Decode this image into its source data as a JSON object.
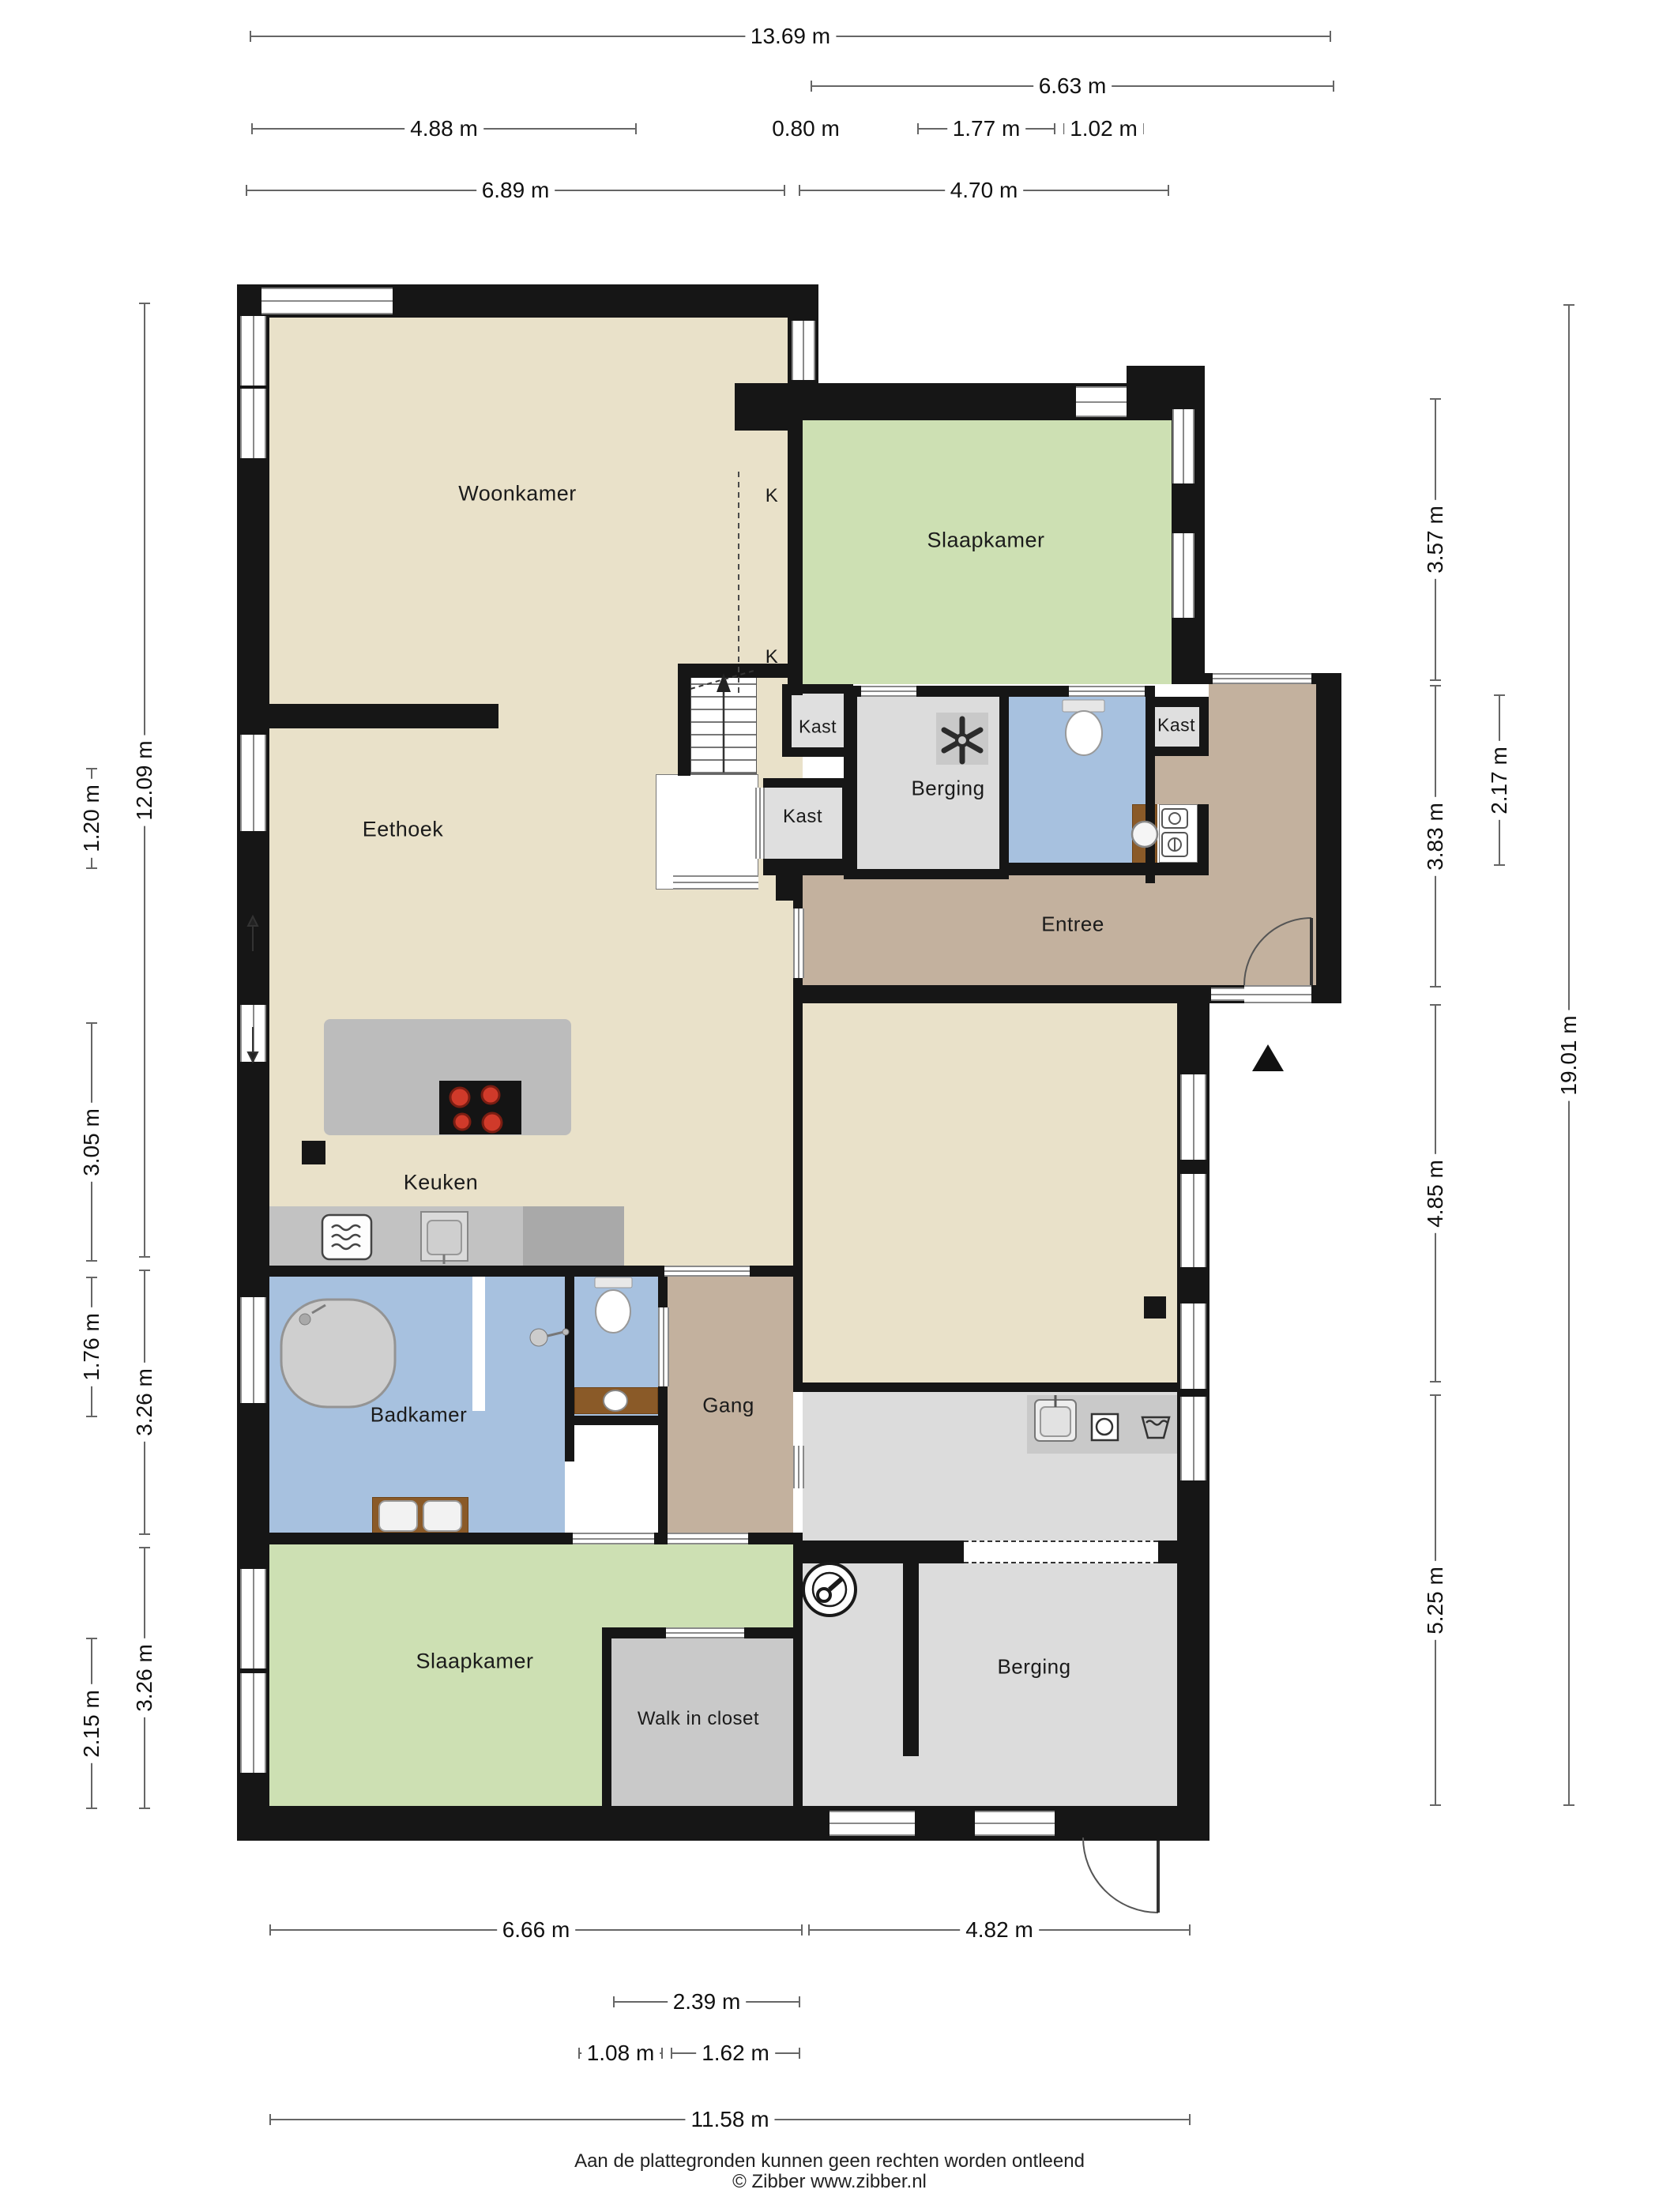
{
  "labels": [
    {
      "text": "Woonkamer"
    },
    {
      "text": "Slaapkamer"
    },
    {
      "text": "K"
    },
    {
      "text": "K"
    },
    {
      "text": "Kast"
    },
    {
      "text": "Kast"
    },
    {
      "text": "Kast"
    },
    {
      "text": "Berging"
    },
    {
      "text": "Entree"
    },
    {
      "text": "Eethoek"
    },
    {
      "text": "Keuken"
    },
    {
      "text": "Badkamer"
    },
    {
      "text": "Gang"
    },
    {
      "text": "Slaapkamer"
    },
    {
      "text": "Walk in closet"
    },
    {
      "text": "Berging"
    }
  ],
  "dims": [
    {
      "text": "13.69 m"
    },
    {
      "text": "6.63 m"
    },
    {
      "text": "4.88 m"
    },
    {
      "text": "0.80 m"
    },
    {
      "text": "1.77 m"
    },
    {
      "text": "1.02 m"
    },
    {
      "text": "6.89 m"
    },
    {
      "text": "4.70 m"
    },
    {
      "text": "12.09 m"
    },
    {
      "text": "3.26 m"
    },
    {
      "text": "3.26 m"
    },
    {
      "text": "1.20 m"
    },
    {
      "text": "3.05 m"
    },
    {
      "text": "1.76 m"
    },
    {
      "text": "2.15 m"
    },
    {
      "text": "3.57 m"
    },
    {
      "text": "3.83 m"
    },
    {
      "text": "4.85 m"
    },
    {
      "text": "5.25 m"
    },
    {
      "text": "2.17 m"
    },
    {
      "text": "19.01 m"
    },
    {
      "text": "6.66 m"
    },
    {
      "text": "4.82 m"
    },
    {
      "text": "2.39 m"
    },
    {
      "text": "1.08 m"
    },
    {
      "text": "1.62 m"
    },
    {
      "text": "11.58 m"
    }
  ],
  "footer": {
    "line1": "Aan de plattegronden kunnen geen rechten worden ontleend",
    "line2": "© Zibber www.zibber.nl"
  },
  "colors": {
    "floor": "#e9e1c9",
    "bedroom": "#cde0b3",
    "bath": "#a7c1df",
    "hall": "#c3b19e",
    "storage": "#dcdcdc",
    "wall": "#161616",
    "wood": "#8a5a28",
    "burner": "#c63a28"
  }
}
